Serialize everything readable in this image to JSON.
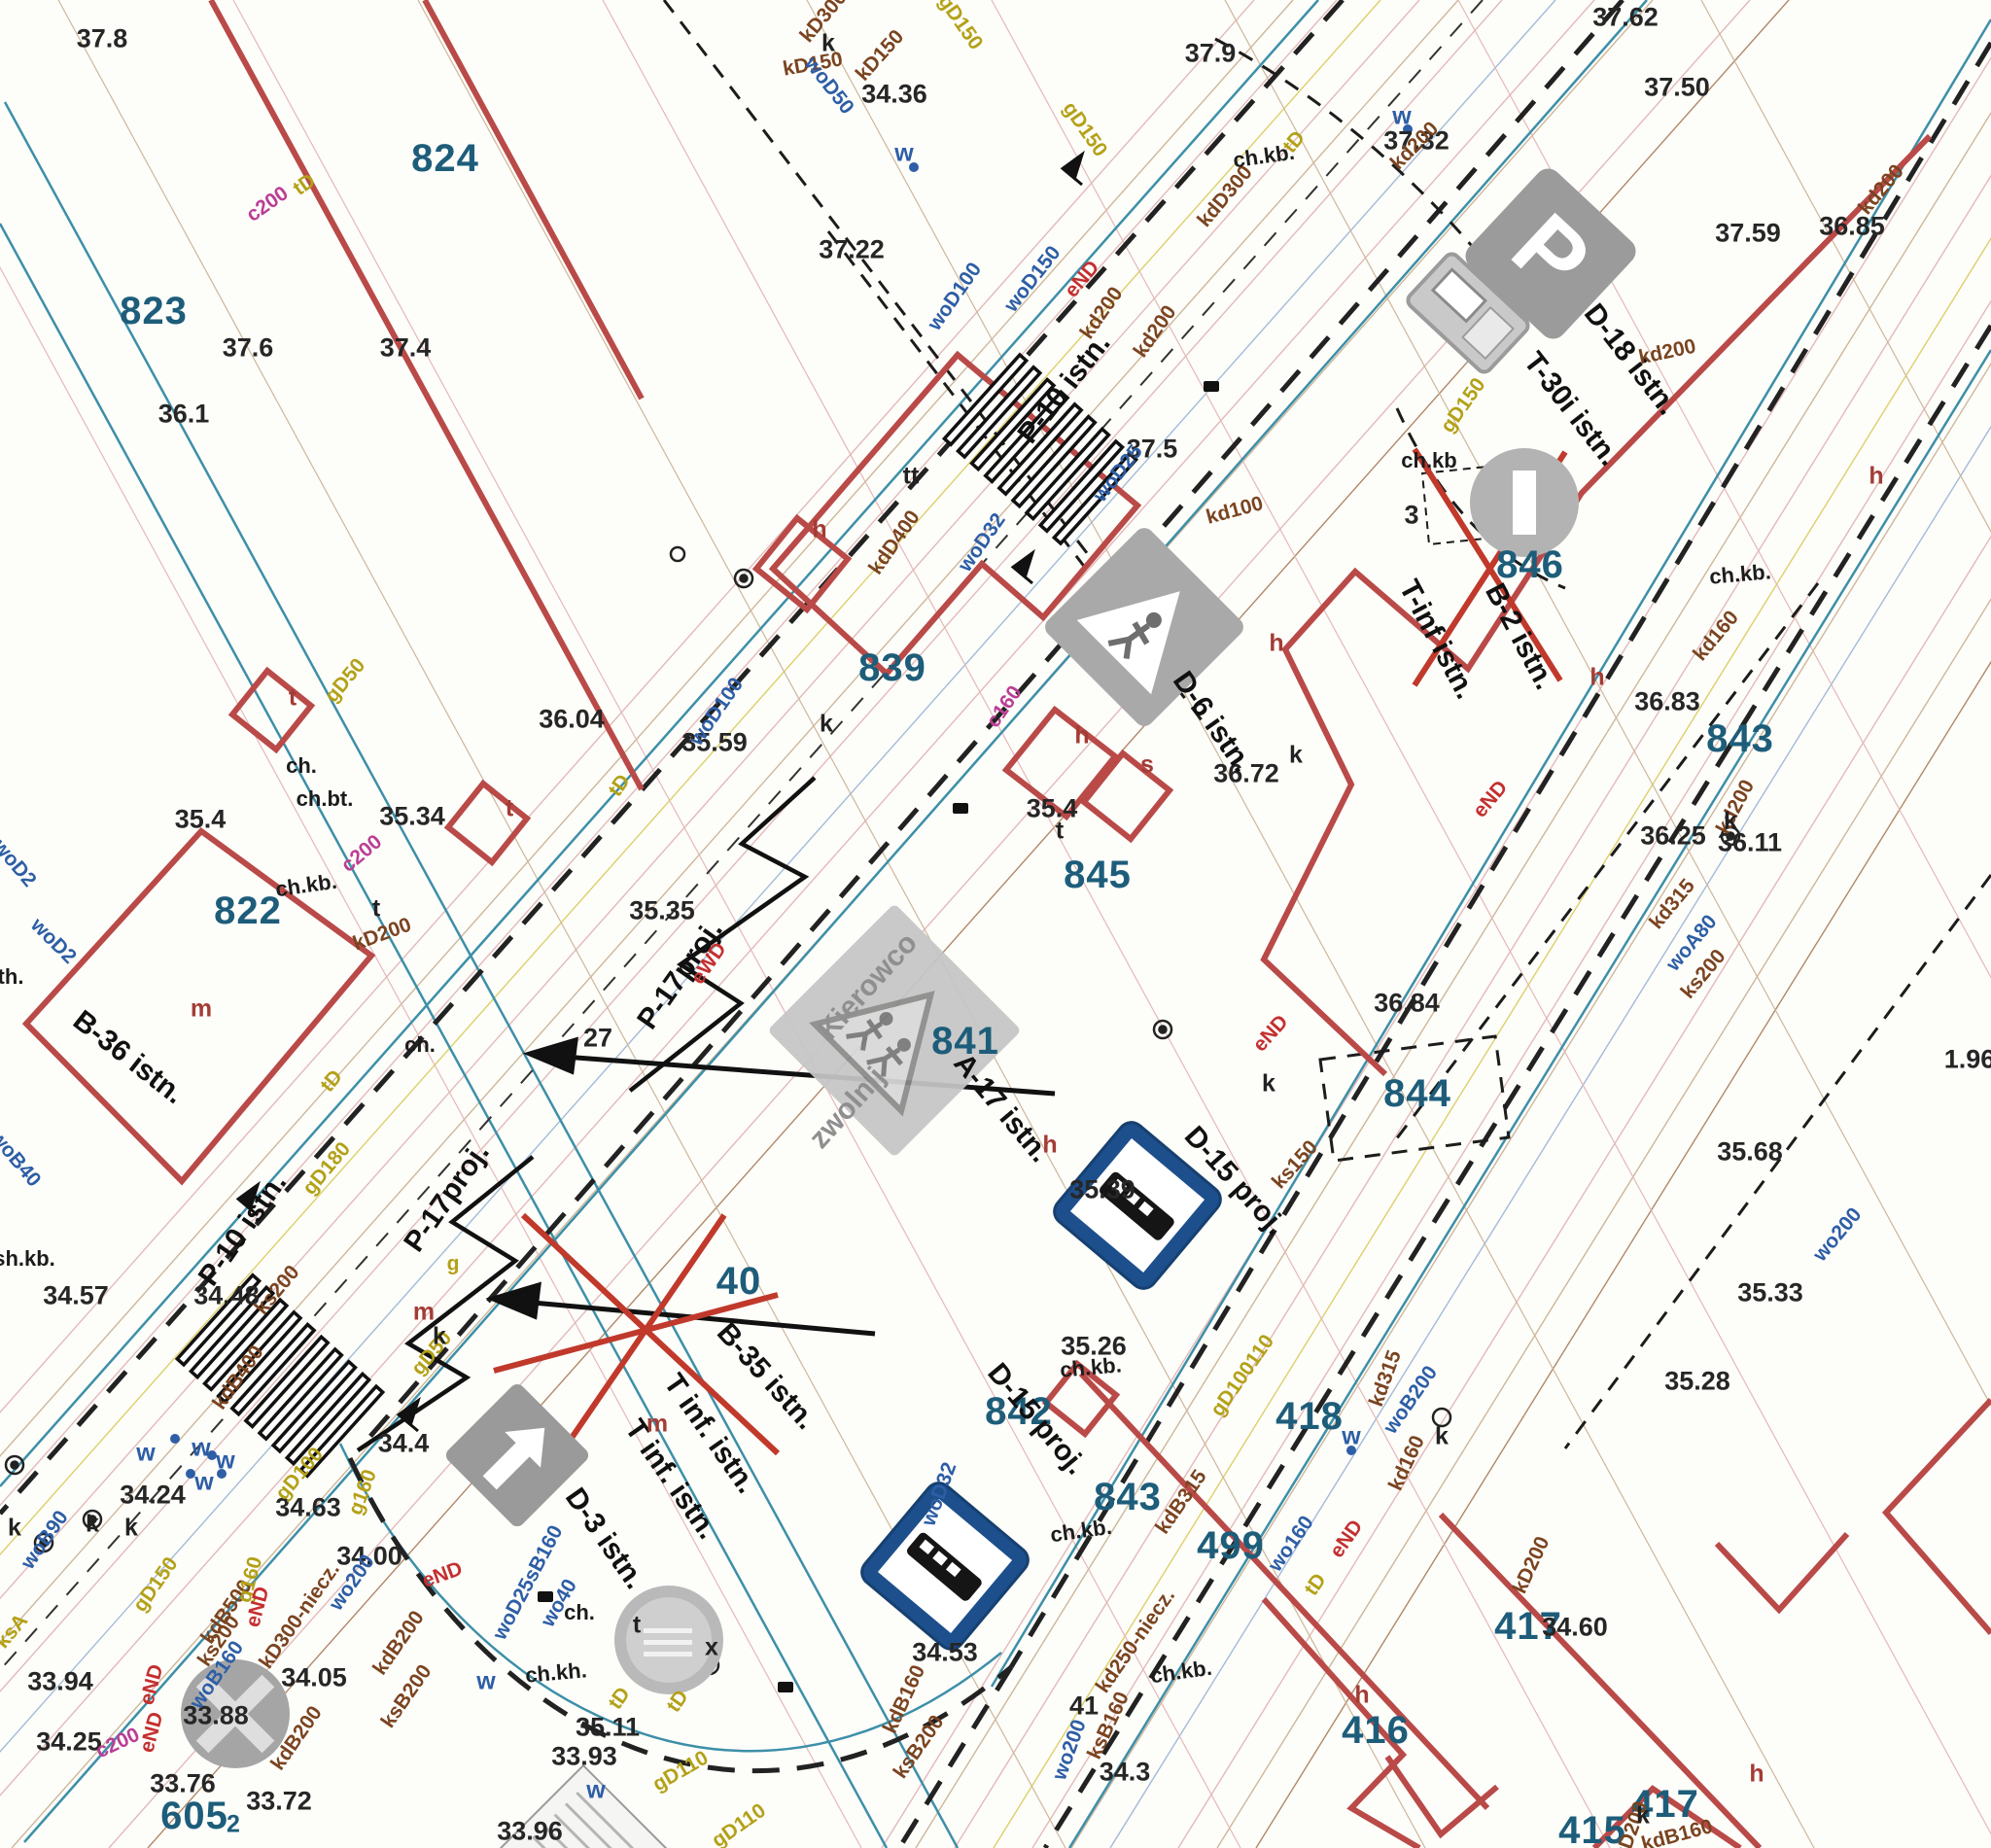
{
  "signs": {
    "parking_letter": "P",
    "kierowco_line1": "Kierowco",
    "kierowco_line2": "zwolnij"
  },
  "labels": {
    "parcels": [
      [
        "824",
        458,
        163,
        0
      ],
      [
        "823",
        158,
        320,
        0
      ],
      [
        "822",
        255,
        937,
        0
      ],
      [
        "839",
        918,
        687,
        0
      ],
      [
        "845",
        1129,
        900,
        0
      ],
      [
        "846",
        1574,
        581,
        0
      ],
      [
        "841",
        993,
        1071,
        0
      ],
      [
        "844",
        1458,
        1125,
        0
      ],
      [
        "843",
        1790,
        760,
        0
      ],
      [
        "843",
        1160,
        1540,
        0
      ],
      [
        "499",
        1266,
        1590,
        0
      ],
      [
        "842",
        1048,
        1452,
        0
      ],
      [
        "40",
        760,
        1318,
        0
      ],
      [
        "418",
        1347,
        1457,
        0
      ],
      [
        "416",
        1415,
        1780,
        0
      ],
      [
        "417",
        1572,
        1673,
        0
      ],
      [
        "417",
        1713,
        1856,
        0
      ],
      [
        "415",
        1638,
        1883,
        0
      ],
      [
        "605",
        200,
        1868,
        0
      ]
    ],
    "elevations": [
      [
        "37.8",
        105,
        40,
        0
      ],
      [
        "37.9",
        1245,
        55,
        0
      ],
      [
        "37.62",
        1672,
        18,
        0
      ],
      [
        "37.50",
        1725,
        90,
        0
      ],
      [
        "36.85",
        1905,
        233,
        0
      ],
      [
        "37.59",
        1798,
        240,
        0
      ],
      [
        "37.32",
        1457,
        145,
        0
      ],
      [
        "37.22",
        876,
        257,
        0
      ],
      [
        "34.36",
        920,
        97,
        0
      ],
      [
        "37.6",
        255,
        358,
        0
      ],
      [
        "37.4",
        417,
        358,
        0
      ],
      [
        "36.1",
        189,
        426,
        0
      ],
      [
        "37.5",
        1185,
        462,
        0
      ],
      [
        "36.04",
        588,
        740,
        0
      ],
      [
        "35.59",
        735,
        764,
        0
      ],
      [
        "35.35",
        681,
        937,
        0
      ],
      [
        "35.34",
        424,
        840,
        0
      ],
      [
        "35.4",
        206,
        843,
        0
      ],
      [
        "35.4",
        1082,
        832,
        0
      ],
      [
        "36.72",
        1282,
        796,
        0
      ],
      [
        "36.83",
        1715,
        722,
        0
      ],
      [
        "36.25",
        1721,
        860,
        0
      ],
      [
        "36.11",
        1800,
        867,
        0
      ],
      [
        "36.84",
        1447,
        1032,
        0
      ],
      [
        "35.68",
        1800,
        1185,
        0
      ],
      [
        "35.33",
        1821,
        1330,
        0
      ],
      [
        "35.28",
        1746,
        1421,
        0
      ],
      [
        "1.96",
        2026,
        1090,
        0
      ],
      [
        "35.39",
        1134,
        1224,
        0
      ],
      [
        "35.26",
        1125,
        1385,
        0
      ],
      [
        "27",
        615,
        1068,
        0
      ],
      [
        "3",
        1452,
        530,
        0
      ],
      [
        "34.48",
        233,
        1333,
        0
      ],
      [
        "34.57",
        78,
        1333,
        0
      ],
      [
        "34.4",
        415,
        1485,
        0
      ],
      [
        "34.24",
        157,
        1538,
        0
      ],
      [
        "34.63",
        317,
        1551,
        0
      ],
      [
        "34.00",
        380,
        1601,
        0
      ],
      [
        "34.05",
        323,
        1726,
        0
      ],
      [
        "33.94",
        62,
        1730,
        0
      ],
      [
        "33.88",
        222,
        1765,
        0
      ],
      [
        "34.25",
        71,
        1792,
        0
      ],
      [
        "33.76",
        188,
        1835,
        0
      ],
      [
        "33.72",
        287,
        1853,
        0
      ],
      [
        "33.96",
        545,
        1884,
        0
      ],
      [
        "33.93",
        601,
        1807,
        0
      ],
      [
        "35.11",
        625,
        1777,
        0
      ],
      [
        "34.53",
        972,
        1700,
        0
      ],
      [
        "34.3",
        1157,
        1823,
        0
      ],
      [
        "34.60",
        1620,
        1674,
        0
      ],
      [
        "41",
        1115,
        1755,
        0
      ]
    ],
    "signs": [
      [
        "P-10 istn.",
        1095,
        400,
        -52
      ],
      [
        "P-10 istn.",
        250,
        1265,
        -55
      ],
      [
        "P-17proj.",
        700,
        1003,
        -55
      ],
      [
        "P-17proj.",
        460,
        1232,
        -55
      ],
      [
        "D-18 istn.",
        1677,
        370,
        52
      ],
      [
        "T-30i istn.",
        1616,
        421,
        52
      ],
      [
        "B-2 istn.",
        1563,
        655,
        62
      ],
      [
        "T-inf istn.",
        1478,
        658,
        62
      ],
      [
        "D-6 istn.",
        1247,
        743,
        55
      ],
      [
        "A-17 istn.",
        1030,
        1140,
        50
      ],
      [
        "D-15 proj.",
        1270,
        1215,
        48
      ],
      [
        "D-15 proj.",
        1066,
        1460,
        50
      ],
      [
        "B-35 istn.",
        788,
        1416,
        48
      ],
      [
        "T inf. istn.",
        730,
        1475,
        55
      ],
      [
        "T inf. istn.",
        690,
        1522,
        55
      ],
      [
        "D-3 istn.",
        622,
        1583,
        55
      ],
      [
        "B-36 istn.",
        132,
        1088,
        38
      ]
    ],
    "utilities": [
      [
        "kD300",
        847,
        17,
        -50,
        "brown"
      ],
      [
        "kD150",
        836,
        66,
        -10,
        "brown"
      ],
      [
        "kD150",
        905,
        57,
        -48,
        "brown"
      ],
      [
        "kdD300",
        1260,
        202,
        -50,
        "brown"
      ],
      [
        "kd200",
        1133,
        322,
        -55,
        "brown"
      ],
      [
        "kd200",
        1455,
        150,
        -45,
        "brown"
      ],
      [
        "kd200",
        1935,
        195,
        -50,
        "brown"
      ],
      [
        "kd200",
        1715,
        362,
        -12,
        "brown"
      ],
      [
        "kd100",
        1270,
        525,
        -15,
        "brown"
      ],
      [
        "kdD400",
        920,
        558,
        -55,
        "brown"
      ],
      [
        "kd200",
        1785,
        830,
        -62,
        "brown"
      ],
      [
        "kd160",
        1765,
        654,
        -50,
        "brown"
      ],
      [
        "kd315",
        1720,
        930,
        -50,
        "brown"
      ],
      [
        "ks200",
        1752,
        1002,
        -50,
        "brown"
      ],
      [
        "ks150",
        1332,
        1198,
        -48,
        "brown"
      ],
      [
        "kdB315",
        1215,
        1545,
        -55,
        "brown"
      ],
      [
        "kd250-niecz.",
        1168,
        1688,
        -55,
        "brown"
      ],
      [
        "kdB500",
        233,
        1658,
        -55,
        "brown"
      ],
      [
        "ks200",
        225,
        1688,
        -55,
        "brown"
      ],
      [
        "ks200",
        285,
        1327,
        -50,
        "brown"
      ],
      [
        "kdB400",
        245,
        1417,
        -55,
        "brown"
      ],
      [
        "kD300-niecz.",
        308,
        1662,
        -55,
        "brown"
      ],
      [
        "kdB200",
        410,
        1690,
        -55,
        "brown"
      ],
      [
        "ksB200",
        418,
        1745,
        -55,
        "brown"
      ],
      [
        "kdB200",
        305,
        1788,
        -55,
        "brown"
      ],
      [
        "ksB200",
        945,
        1797,
        -55,
        "brown"
      ],
      [
        "kdB160",
        930,
        1748,
        -65,
        "brown"
      ],
      [
        "kdB160",
        1725,
        1888,
        -15,
        "brown"
      ],
      [
        "kD200",
        1575,
        1610,
        -65,
        "brown"
      ],
      [
        "kD200",
        1678,
        1883,
        -70,
        "brown"
      ],
      [
        "kd160",
        1447,
        1505,
        -65,
        "brown"
      ],
      [
        "kd315",
        1425,
        1418,
        -70,
        "brown"
      ],
      [
        "ksB160",
        1140,
        1775,
        -65,
        "brown"
      ],
      [
        "kD200",
        393,
        961,
        -20,
        "brown"
      ],
      [
        "kd200",
        1188,
        341,
        -55,
        "brown"
      ],
      [
        "woD50",
        853,
        88,
        52,
        "blue"
      ],
      [
        "woD100",
        982,
        305,
        -55,
        "blue"
      ],
      [
        "woD150",
        1062,
        287,
        -52,
        "blue"
      ],
      [
        "woD100",
        737,
        732,
        -55,
        "blue"
      ],
      [
        "woD32",
        1010,
        558,
        -55,
        "blue"
      ],
      [
        "woD32",
        966,
        1537,
        -70,
        "blue"
      ],
      [
        "woD25",
        1150,
        487,
        -52,
        "blue"
      ],
      [
        "wo160",
        1328,
        1588,
        -55,
        "blue"
      ],
      [
        "wo200",
        1100,
        1800,
        -70,
        "blue"
      ],
      [
        "wo200",
        1890,
        1270,
        -50,
        "blue"
      ],
      [
        "woA80",
        1740,
        970,
        -50,
        "blue"
      ],
      [
        "woB160",
        223,
        1723,
        -55,
        "blue"
      ],
      [
        "woB90",
        46,
        1584,
        -55,
        "blue"
      ],
      [
        "wo200",
        362,
        1628,
        -55,
        "blue"
      ],
      [
        "woB200",
        1451,
        1440,
        -55,
        "blue"
      ],
      [
        "wo40",
        575,
        1649,
        -60,
        "blue"
      ],
      [
        "woD25sB160",
        543,
        1628,
        -62,
        "blue"
      ],
      [
        "woD2",
        15,
        888,
        50,
        "blue"
      ],
      [
        "woD2",
        55,
        968,
        45,
        "blue"
      ],
      [
        "woB40",
        16,
        1192,
        50,
        "blue"
      ],
      [
        "gD150",
        988,
        23,
        55,
        "yellow"
      ],
      [
        "gD150",
        1116,
        133,
        55,
        "yellow"
      ],
      [
        "gD50",
        355,
        700,
        -50,
        "yellow"
      ],
      [
        "gD50",
        444,
        1392,
        -50,
        "yellow"
      ],
      [
        "gD180",
        336,
        1202,
        -50,
        "yellow"
      ],
      [
        "gD100",
        308,
        1516,
        -50,
        "yellow"
      ],
      [
        "g160",
        373,
        1535,
        -70,
        "yellow"
      ],
      [
        "gD150",
        160,
        1630,
        -55,
        "yellow"
      ],
      [
        "g160",
        257,
        1625,
        -75,
        "yellow"
      ],
      [
        "gD110",
        700,
        1822,
        -30,
        "yellow"
      ],
      [
        "gD110",
        760,
        1878,
        -35,
        "yellow"
      ],
      [
        "gD100110",
        1278,
        1415,
        -55,
        "yellow"
      ],
      [
        "gD150",
        1505,
        417,
        -55,
        "yellow"
      ],
      [
        "ksA",
        12,
        1678,
        -50,
        "yellow"
      ],
      [
        "g",
        466,
        1300,
        0,
        "yellow"
      ],
      [
        "tD",
        313,
        190,
        -35,
        "yellow"
      ],
      [
        "tD",
        637,
        808,
        -55,
        "yellow"
      ],
      [
        "tD",
        341,
        1112,
        -50,
        "yellow"
      ],
      [
        "tD",
        1353,
        1630,
        -55,
        "yellow"
      ],
      [
        "tD",
        637,
        1747,
        -55,
        "yellow"
      ],
      [
        "tD",
        697,
        1750,
        -55,
        "yellow"
      ],
      [
        "tD",
        1331,
        146,
        -50,
        "yellow"
      ],
      [
        "c200",
        275,
        210,
        -35,
        "magenta"
      ],
      [
        "c160",
        1033,
        727,
        -55,
        "magenta"
      ],
      [
        "c200",
        121,
        1793,
        -25,
        "magenta"
      ],
      [
        "c200",
        372,
        878,
        -40,
        "magenta"
      ],
      [
        "eND",
        1113,
        287,
        -50,
        "red"
      ],
      [
        "eND",
        1307,
        1063,
        -48,
        "red"
      ],
      [
        "eND",
        1533,
        822,
        -50,
        "red"
      ],
      [
        "eND",
        455,
        1620,
        -20,
        "red"
      ],
      [
        "eND",
        156,
        1733,
        -75,
        "red"
      ],
      [
        "eND",
        156,
        1782,
        -75,
        "red"
      ],
      [
        "eND",
        265,
        1653,
        -75,
        "red"
      ],
      [
        "eND",
        1385,
        1583,
        -55,
        "red"
      ],
      [
        "eWD",
        729,
        991,
        -55,
        "red"
      ]
    ],
    "surfaces": [
      [
        "ch.kb.",
        1300,
        161,
        -8
      ],
      [
        "ch.kb",
        1470,
        474,
        0
      ],
      [
        "ch.kb.",
        315,
        911,
        -8
      ],
      [
        "ch.kb.",
        1790,
        591,
        -5
      ],
      [
        "ch.kb.",
        1112,
        1575,
        -8
      ],
      [
        "ch.kb.",
        1215,
        1720,
        -8
      ],
      [
        "ch.kb.",
        1122,
        1407,
        -5
      ],
      [
        "ch.kh.",
        572,
        1721,
        -5
      ],
      [
        "ch.",
        596,
        1659,
        0
      ],
      [
        "ch.",
        432,
        1075,
        0
      ],
      [
        "ch.",
        310,
        788,
        0
      ],
      [
        "ch.bt.",
        334,
        822,
        0
      ],
      [
        "th.",
        11,
        1005,
        0
      ],
      [
        "sh.kb.",
        25,
        1295,
        0
      ]
    ],
    "letters": [
      [
        "h",
        843,
        545,
        0,
        "r"
      ],
      [
        "h",
        1113,
        757,
        0,
        "r"
      ],
      [
        "s",
        1180,
        787,
        0,
        "r"
      ],
      [
        "h",
        1643,
        697,
        0,
        "r"
      ],
      [
        "h",
        1313,
        662,
        0,
        "r"
      ],
      [
        "h",
        1930,
        490,
        0,
        "r"
      ],
      [
        "h",
        1080,
        1178,
        0,
        "r"
      ],
      [
        "h",
        1807,
        1825,
        0,
        "r"
      ],
      [
        "h",
        1401,
        1744,
        0,
        "r"
      ],
      [
        "t",
        301,
        718,
        0,
        "r"
      ],
      [
        "t",
        524,
        832,
        0,
        "r"
      ],
      [
        "m",
        207,
        1038,
        0,
        "r"
      ],
      [
        "m",
        676,
        1465,
        0,
        "r"
      ],
      [
        "m",
        436,
        1350,
        0,
        "r"
      ],
      [
        "k",
        852,
        45,
        0,
        "k"
      ],
      [
        "k",
        850,
        745,
        0,
        "k"
      ],
      [
        "k",
        1305,
        1115,
        0,
        "k"
      ],
      [
        "k",
        1483,
        1478,
        0,
        "k"
      ],
      [
        "k",
        1690,
        1868,
        0,
        "k"
      ],
      [
        "k",
        1780,
        845,
        0,
        "k"
      ],
      [
        "k",
        1333,
        777,
        0,
        "k"
      ],
      [
        "k",
        452,
        1375,
        0,
        "k"
      ],
      [
        "k",
        15,
        1572,
        0,
        "k"
      ],
      [
        "k",
        95,
        1568,
        0,
        "k"
      ],
      [
        "k",
        135,
        1572,
        0,
        "k"
      ],
      [
        "t",
        1090,
        855,
        0,
        "k"
      ],
      [
        "tt",
        937,
        490,
        0,
        "k"
      ],
      [
        "t",
        655,
        1672,
        0,
        "k"
      ],
      [
        "x",
        732,
        1695,
        0,
        "k"
      ],
      [
        "t",
        387,
        935,
        0,
        "k"
      ],
      [
        "w",
        930,
        158,
        0,
        "b"
      ],
      [
        "w",
        1390,
        1478,
        0,
        "b"
      ],
      [
        "w",
        500,
        1730,
        0,
        "b"
      ],
      [
        "w",
        613,
        1842,
        0,
        "b"
      ],
      [
        "w",
        150,
        1495,
        0,
        "b"
      ],
      [
        "w",
        207,
        1490,
        0,
        "b"
      ],
      [
        "w",
        232,
        1503,
        0,
        "b"
      ],
      [
        "w",
        210,
        1525,
        0,
        "b"
      ],
      [
        "w",
        1442,
        120,
        0,
        "b"
      ],
      [
        "2",
        240,
        1877,
        0,
        "t"
      ]
    ]
  }
}
